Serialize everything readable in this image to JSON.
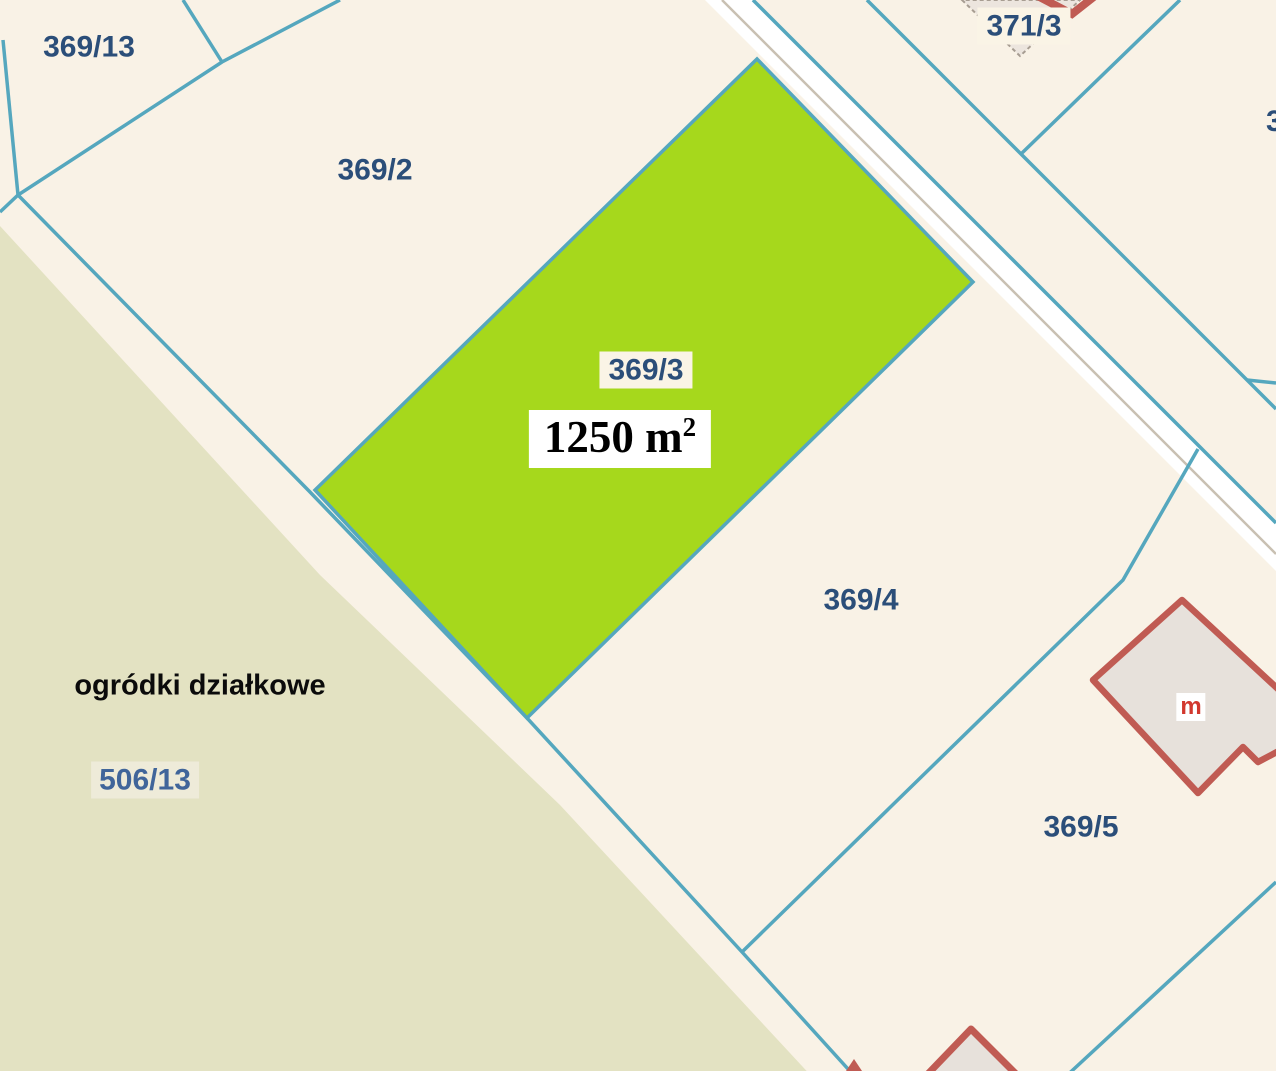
{
  "map": {
    "type": "cadastral-parcel-map",
    "colors": {
      "background_cream": "#F9F2E6",
      "allotment_zone": "#E3E2C2",
      "parcel_boundary_teal": "#55A7BE",
      "highlighted_parcel_green": "#A6D81C",
      "road_surface_white": "#FFFFFF",
      "road_center_grey": "#C9C0B2",
      "building_outline_red": "#C05B53",
      "building_fill_grey": "#E7E1DB",
      "label_navy": "#2B4E79",
      "label_blue_zone": "#40659A",
      "zone_text_black": "#0B0B0B",
      "area_text_black": "#000000",
      "building_letter_red": "#D2382E"
    },
    "labels": {
      "parcel_369_13": "369/13",
      "parcel_369_2": "369/2",
      "parcel_369_3": "369/3",
      "parcel_369_4": "369/4",
      "parcel_369_5": "369/5",
      "parcel_371_3": "371/3",
      "parcel_506_13": "506/13",
      "parcel_right_edge_partial": "3",
      "zone_name": "ogródki działkowe",
      "highlighted_area_value": "1250 m",
      "highlighted_area_superscript": "2",
      "building_letter": "m"
    }
  }
}
